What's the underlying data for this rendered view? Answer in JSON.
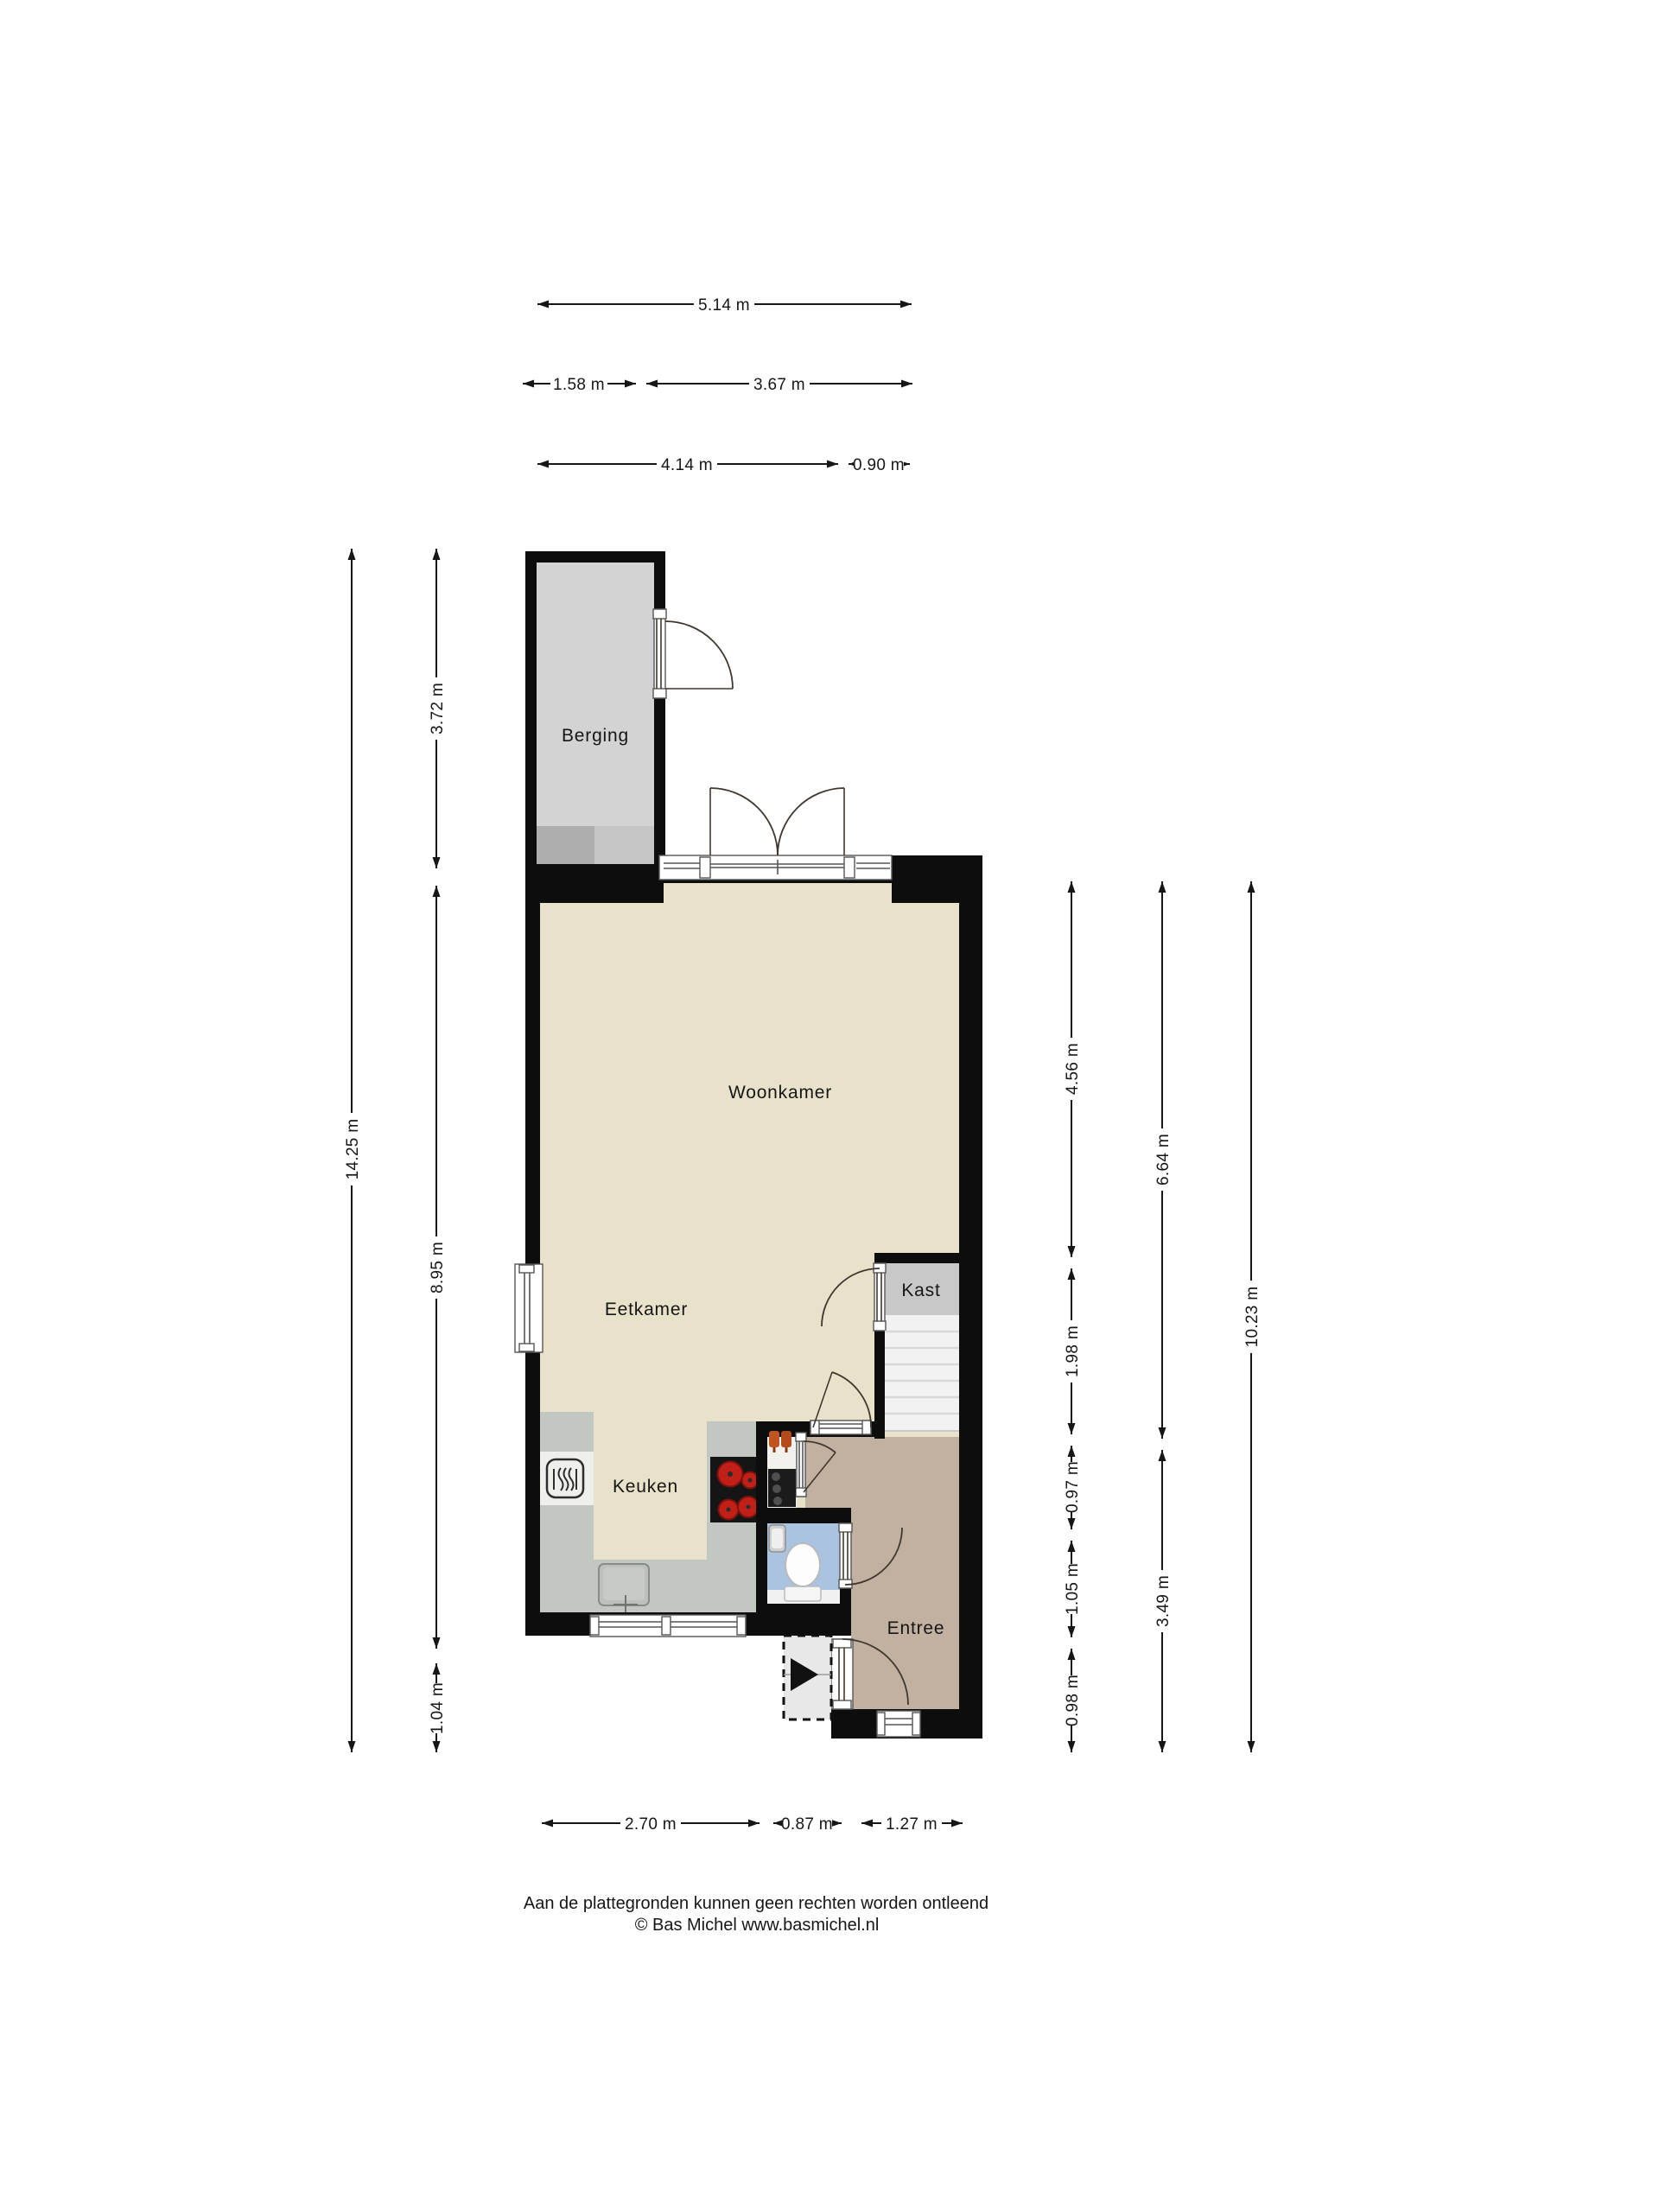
{
  "rooms": {
    "berging": "Berging",
    "woonkamer": "Woonkamer",
    "eetkamer": "Eetkamer",
    "keuken": "Keuken",
    "kast": "Kast",
    "entree": "Entree"
  },
  "dims": {
    "w514": "5.14 m",
    "w158": "1.58 m",
    "w367": "3.67 m",
    "w414": "4.14 m",
    "w090": "0.90 m",
    "h1425": "14.25 m",
    "h372": "3.72 m",
    "h895": "8.95 m",
    "h104": "1.04 m",
    "h456": "4.56 m",
    "h198": "1.98 m",
    "h097": "0.97 m",
    "h105": "1.05 m",
    "h098": "0.98 m",
    "h664": "6.64 m",
    "h349": "3.49 m",
    "h1023": "10.23 m",
    "w270": "2.70 m",
    "w087": "0.87 m",
    "w127": "1.27 m"
  },
  "footer": {
    "disclaimer": "Aan de plattegronden kunnen geen rechten worden ontleend",
    "credit": "© Bas Michel www.basmichel.nl"
  },
  "colors": {
    "wall": "#0d0d0d",
    "floor_main": "#e8e2cb",
    "floor_entree": "#c2b1a0",
    "floor_toilet": "#a9c3e1",
    "floor_kast": "#c8c8c8",
    "floor_berging": "#d3d3d3",
    "counter": "#c2c7c2",
    "stairs": "#f2f2f2",
    "burner_red": "#c02018",
    "accent_orange": "#c05520"
  }
}
